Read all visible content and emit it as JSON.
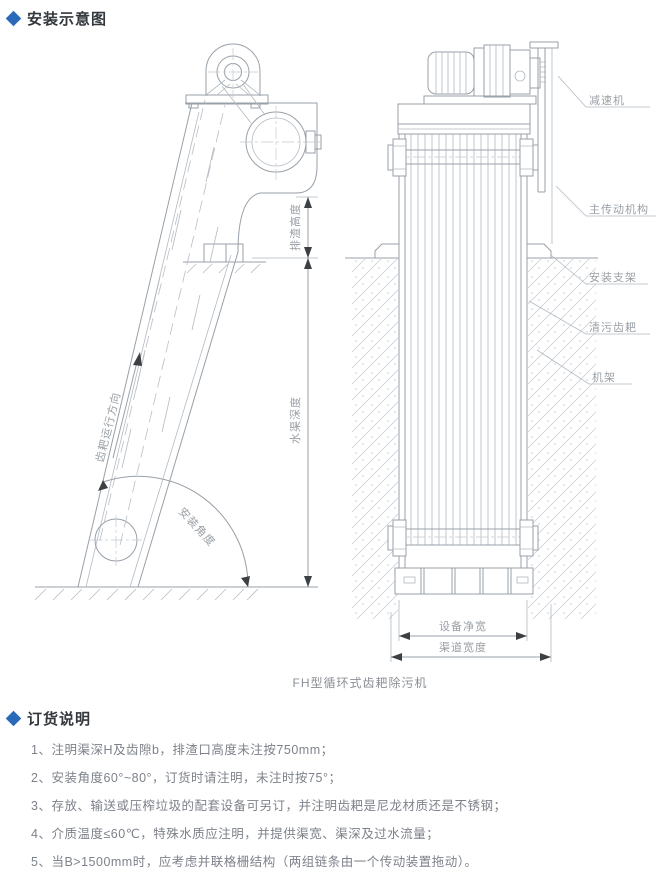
{
  "page": {
    "background": "#ffffff",
    "accent": "#2b6ab8",
    "line_color": "#98a0a8",
    "label_color": "#9aa0a6"
  },
  "install_section": {
    "title": "安装示意图"
  },
  "diagram": {
    "caption": "FH型循环式齿耙除污机",
    "part_labels": {
      "reducer": "减速机",
      "main_drive": "主传动机构",
      "mount_bracket": "安装支架",
      "cleaning_rake": "清污齿耙",
      "frame": "机架"
    },
    "dim_labels": {
      "discharge_height": "排渣高度",
      "channel_depth": "水渠深度",
      "install_angle": "安装角度",
      "rake_direction": "齿耙运行方向",
      "equipment_net_width": "设备净宽",
      "channel_width": "渠道宽度"
    }
  },
  "order_section": {
    "title": "订货说明",
    "items": [
      "1、注明渠深H及齿隙b，排渣口高度未注按750mm；",
      "2、安装角度60°~80°，订货时请注明，未注时按75°；",
      "3、存放、输送或压榨垃圾的配套设备可另订，并注明齿耙是尼龙材质还是不锈钢；",
      "4、介质温度≤60℃，特殊水质应注明，并提供渠宽、渠深及过水流量；",
      "5、当B>1500mm时，应考虑并联格栅结构（两组链条由一个传动装置拖动）。"
    ]
  }
}
